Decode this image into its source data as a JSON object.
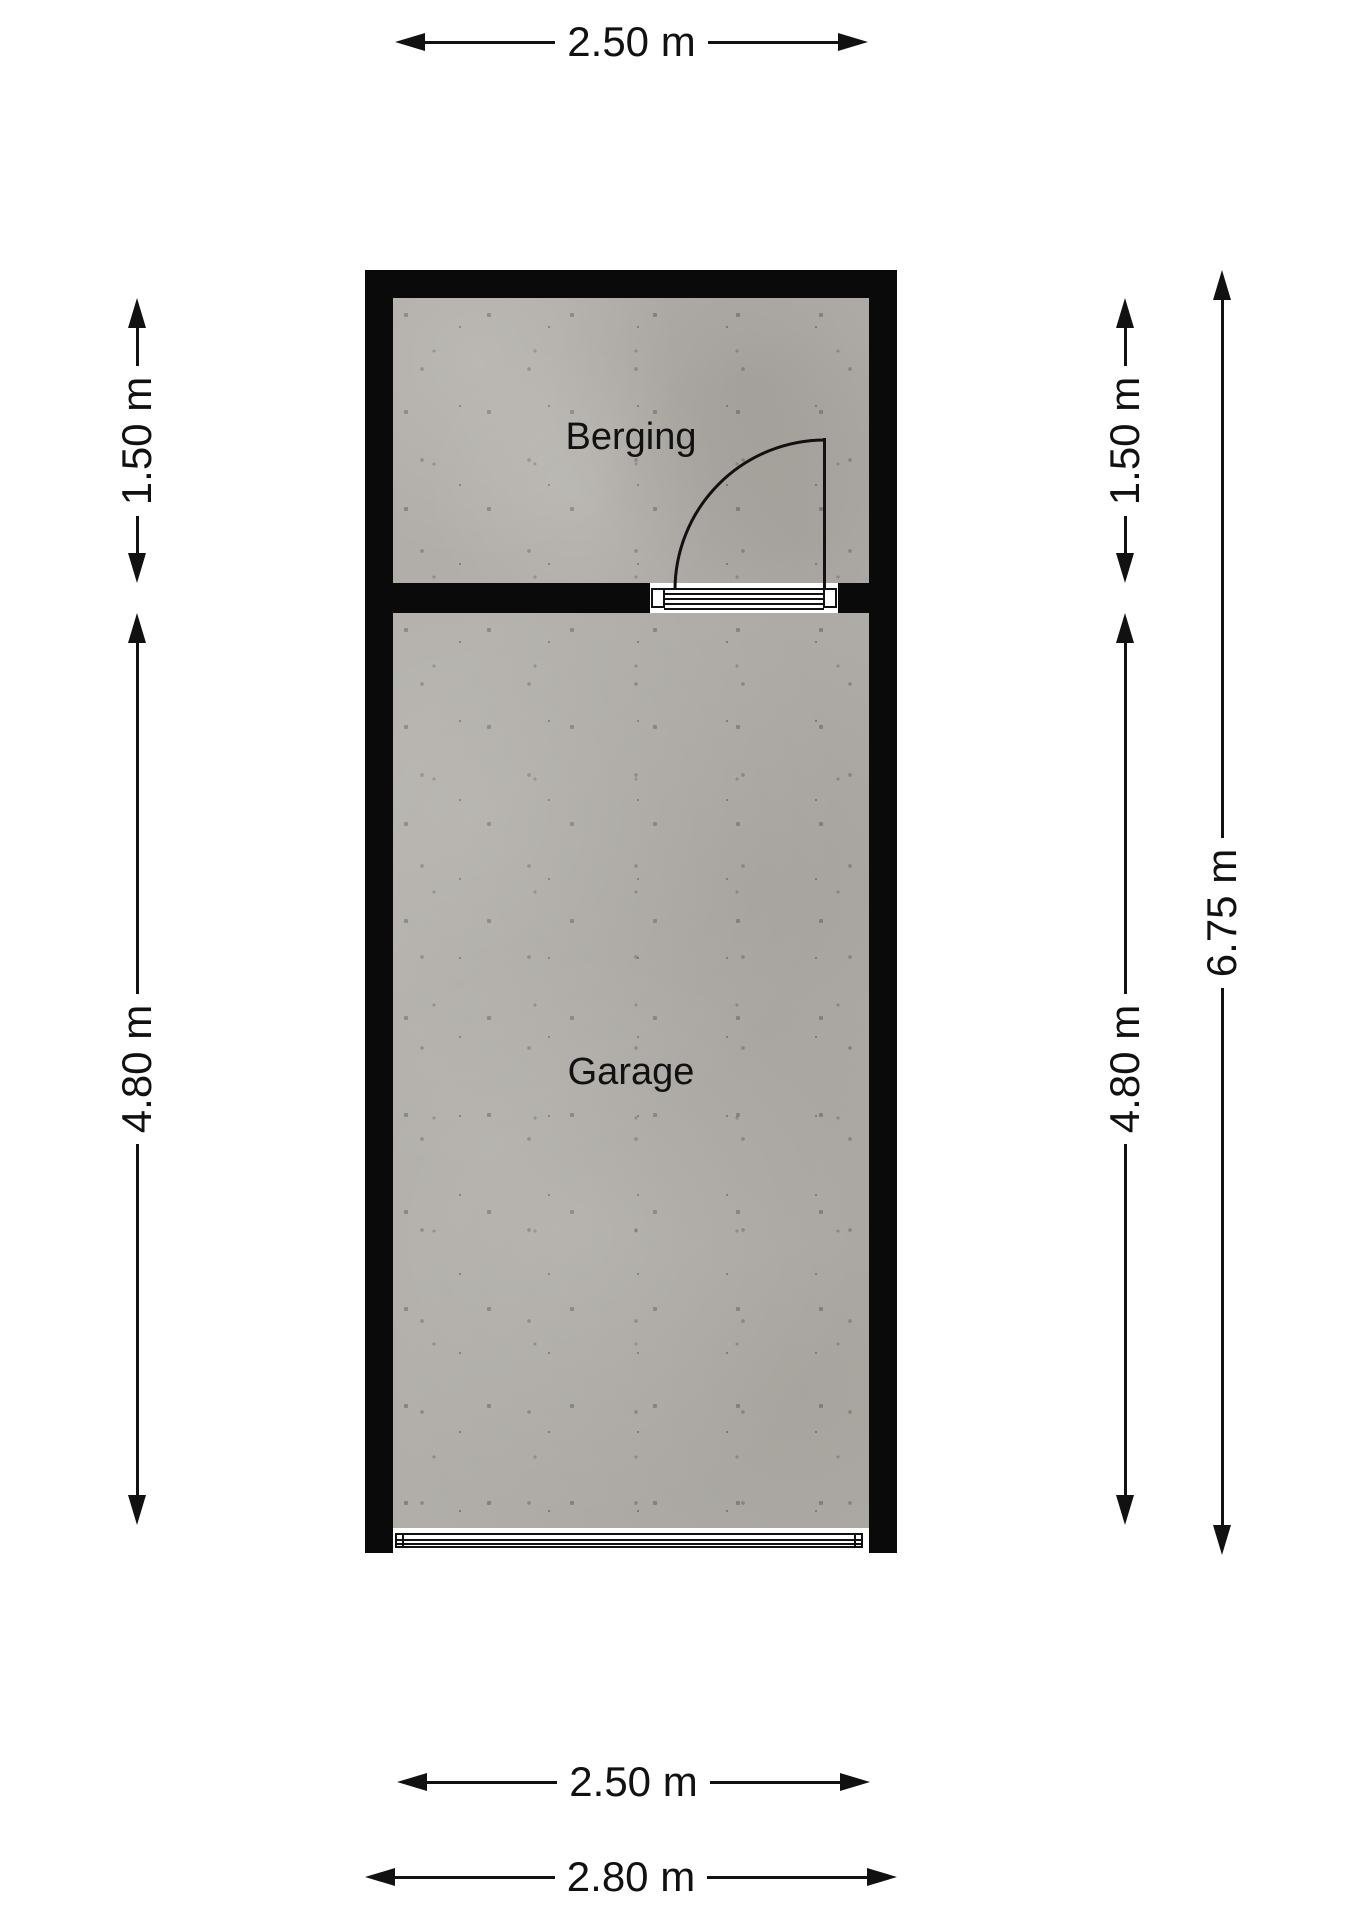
{
  "plan": {
    "rooms": [
      {
        "label": "Berging"
      },
      {
        "label": "Garage"
      }
    ],
    "dimensions": {
      "top_interior_width": "2.50 m",
      "berging_height_left": "1.50 m",
      "garage_height_left": "4.80 m",
      "berging_height_right": "1.50 m",
      "garage_height_right": "4.80 m",
      "total_height_right": "6.75 m",
      "bottom_interior_width": "2.50 m",
      "bottom_exterior_width": "2.80 m"
    },
    "colors": {
      "background": "#ffffff",
      "wall": "#0a0a0a",
      "floor_base": "#b1aea9",
      "dimension_line": "#111111",
      "room_label": "#111111"
    }
  }
}
